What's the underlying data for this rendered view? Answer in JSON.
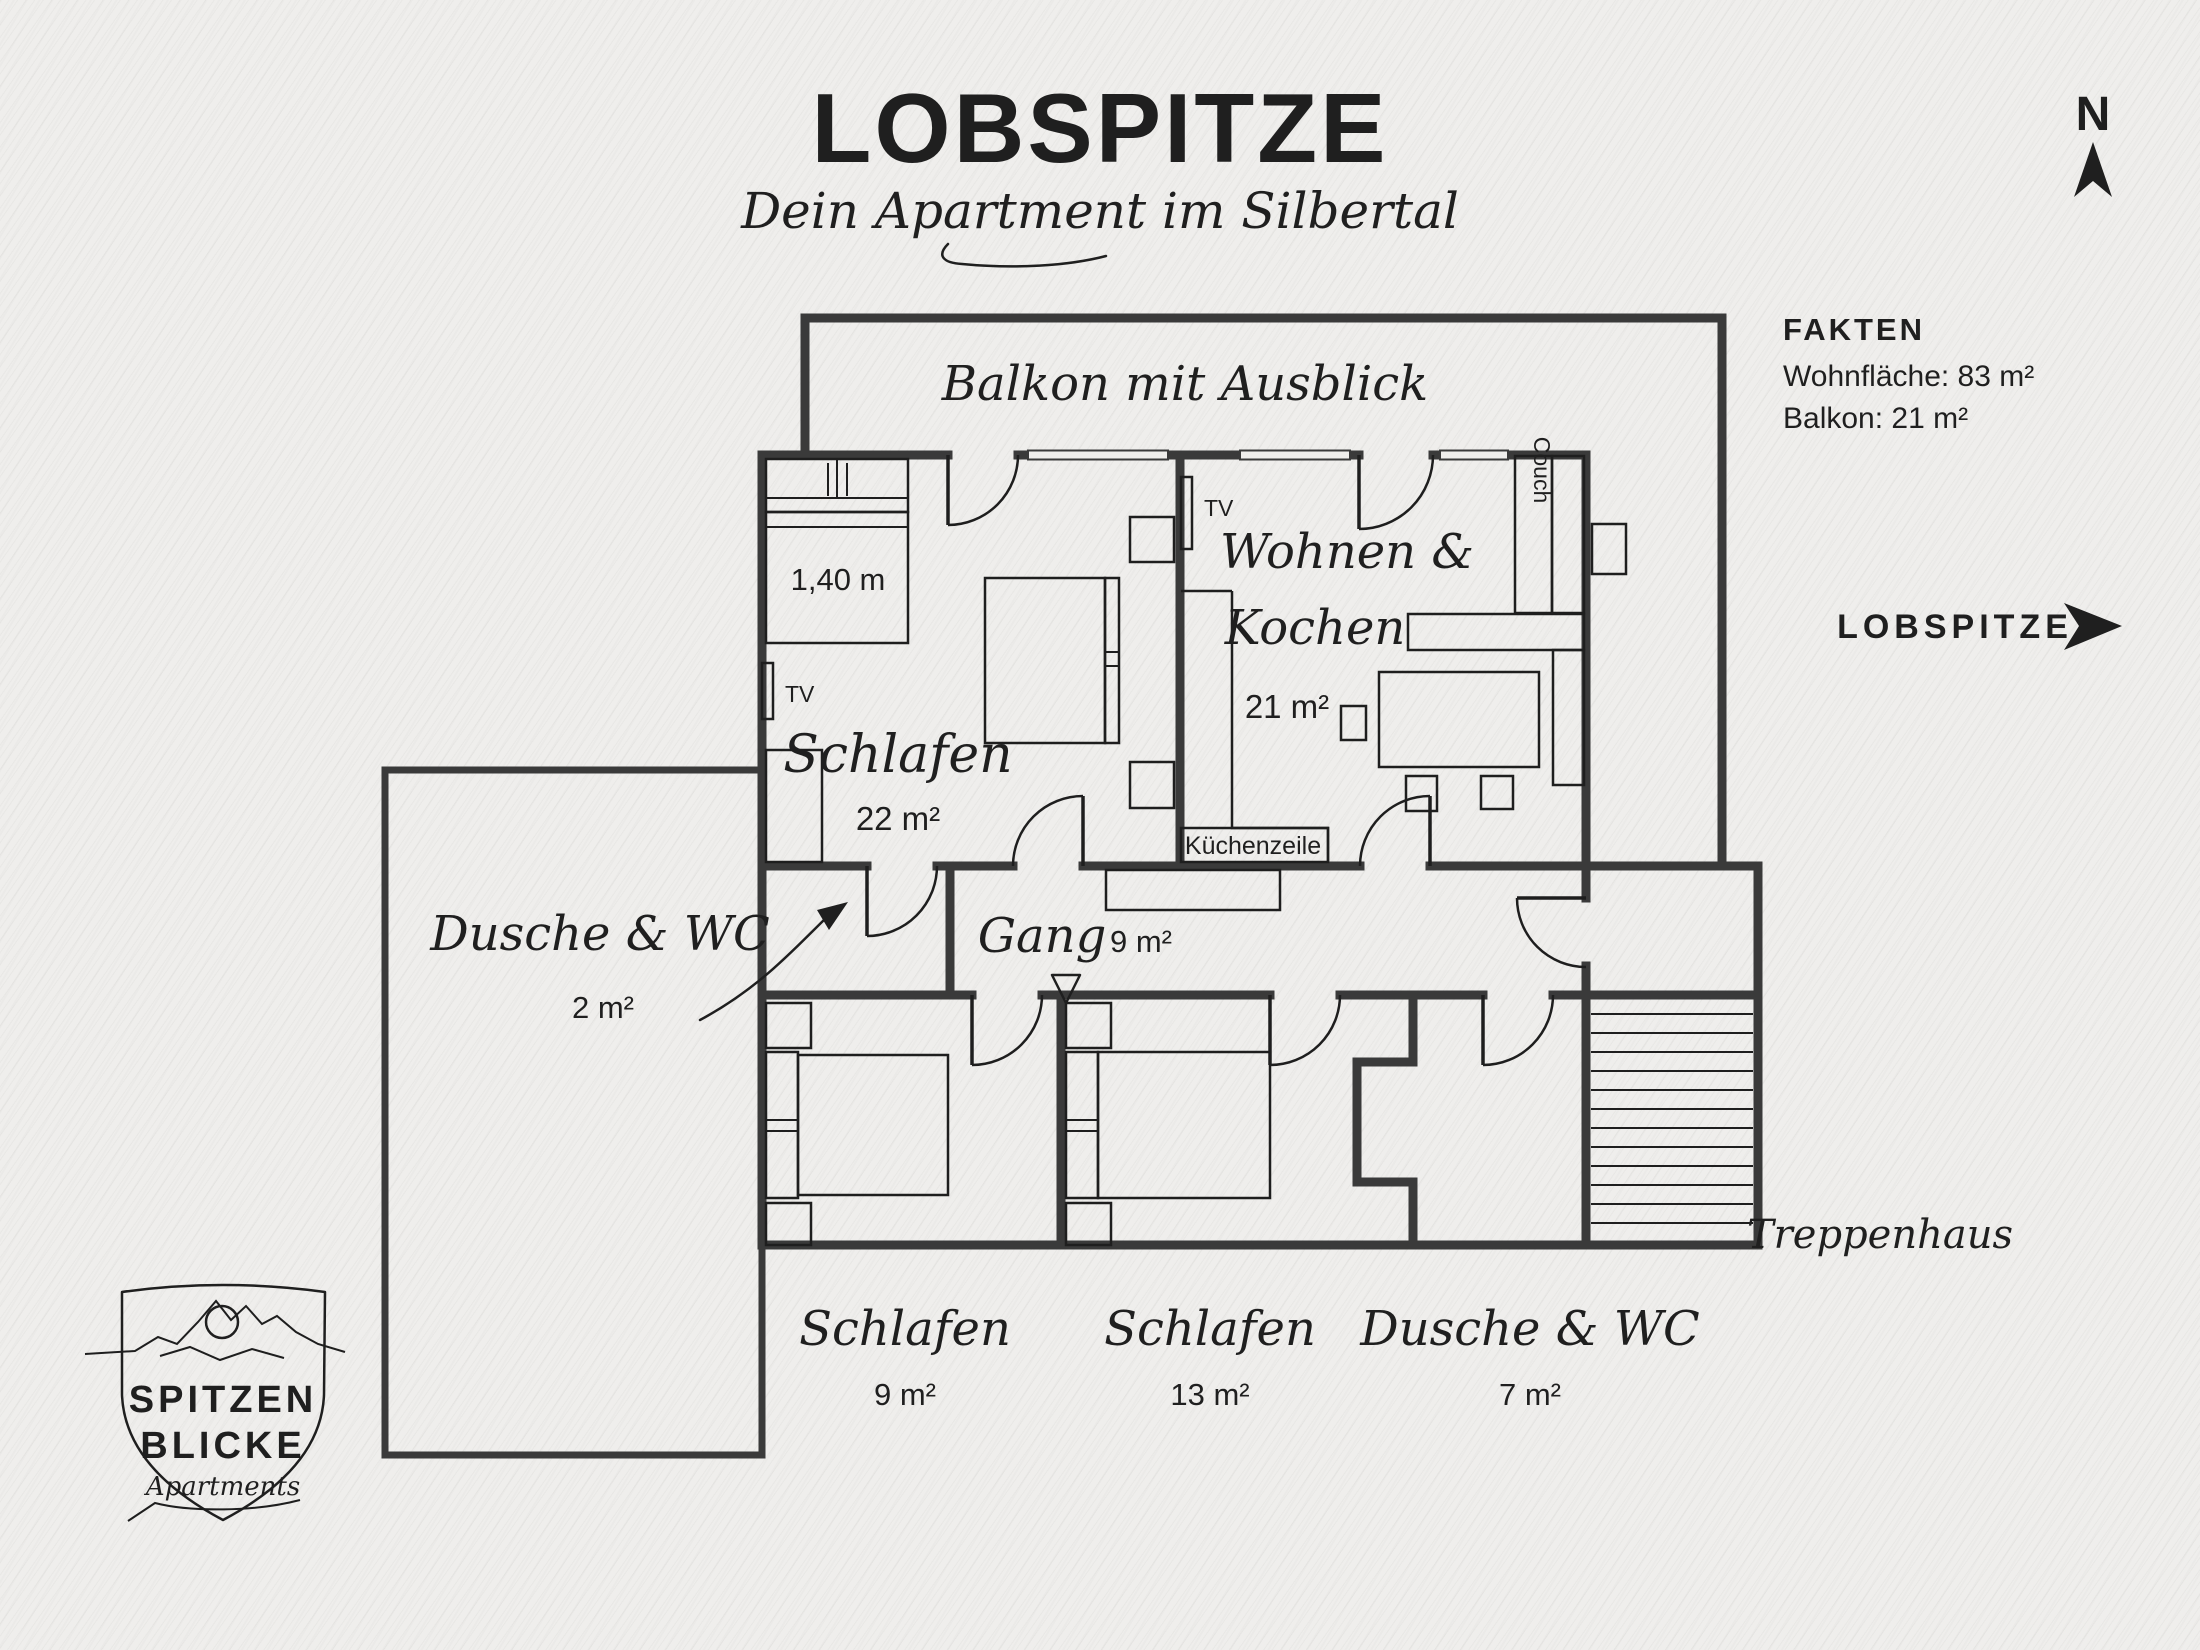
{
  "header": {
    "title": "LOBSPITZE",
    "subtitle": "Dein Apartment im Silbertal"
  },
  "compass": {
    "north": "N"
  },
  "facts": {
    "heading": "FAKTEN",
    "line1": "Wohnfläche:  83 m²",
    "line2": "Balkon: 21 m²"
  },
  "direction": {
    "label": "LOBSPITZE"
  },
  "plan": {
    "balcony": {
      "name": "Balkon mit Ausblick"
    },
    "bedroom_main": {
      "name": "Schlafen",
      "area": "22 m²",
      "bed_width": "1,40 m",
      "tv": "TV"
    },
    "living": {
      "name_line1": "Wohnen &",
      "name_line2": "Kochen",
      "area": "21 m²",
      "tv": "TV",
      "couch": "Couch",
      "kitchen": "Küchenzeile"
    },
    "shower_small": {
      "name": "Dusche & WC",
      "area": "2 m²"
    },
    "hallway": {
      "name": "Gang",
      "area": "9 m²"
    },
    "bedroom_small": {
      "name": "Schlafen",
      "area": "9 m²"
    },
    "bedroom_mid": {
      "name": "Schlafen",
      "area": "13 m²"
    },
    "bath": {
      "name": "Dusche & WC",
      "area": "7 m²"
    },
    "stairs": {
      "name": "Treppenhaus"
    }
  },
  "logo": {
    "line1": "SPITZEN",
    "line2": "BLICKE",
    "tagline": "Apartments"
  }
}
